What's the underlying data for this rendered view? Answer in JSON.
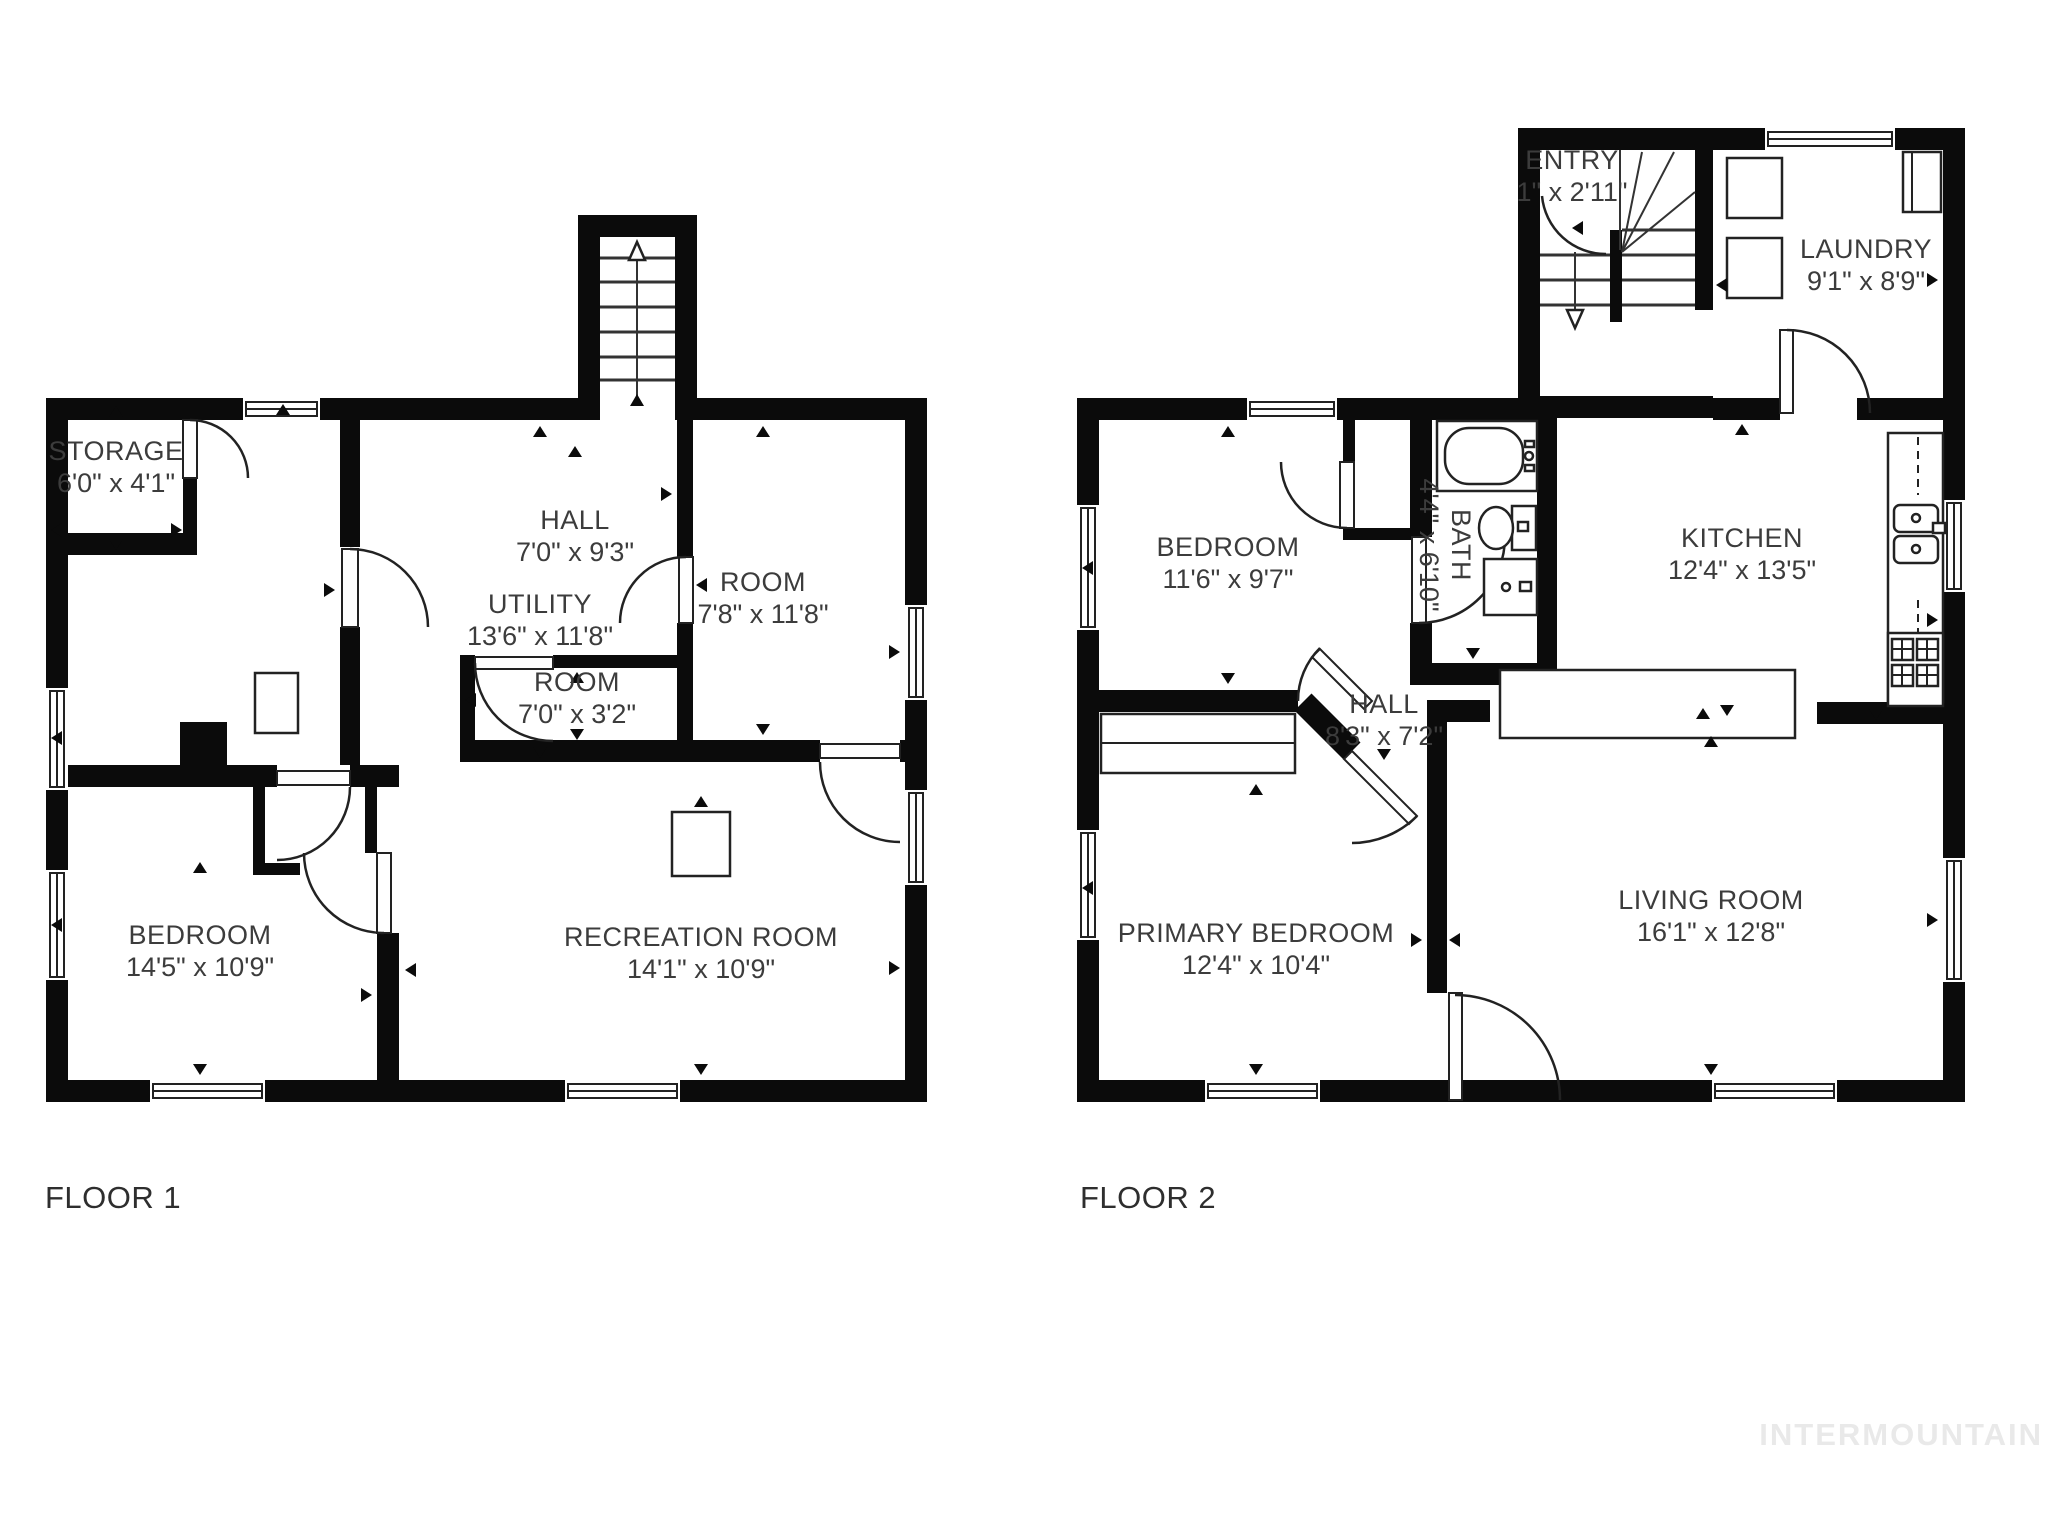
{
  "watermark": {
    "text": "INTERMOUNTAIN"
  },
  "colors": {
    "wall": "#0b0b0b",
    "line": "#222222",
    "label_text": "#3c3c3c",
    "watermark": "#e9e9e9"
  },
  "floor1": {
    "label": "FLOOR 1",
    "rooms": [
      {
        "id": "storage",
        "name": "STORAGE",
        "dims": "6'0\" x 4'1\""
      },
      {
        "id": "utility",
        "name": "UTILITY",
        "dims": "13'6\" x 11'8\""
      },
      {
        "id": "hall",
        "name": "HALL",
        "dims": "7'0\" x 9'3\""
      },
      {
        "id": "room-small",
        "name": "ROOM",
        "dims": "7'0\" x 3'2\""
      },
      {
        "id": "room",
        "name": "ROOM",
        "dims": "7'8\" x 11'8\""
      },
      {
        "id": "bedroom",
        "name": "BEDROOM",
        "dims": "14'5\" x 10'9\""
      },
      {
        "id": "recreation",
        "name": "RECREATION ROOM",
        "dims": "14'1\" x 10'9\""
      }
    ]
  },
  "floor2": {
    "label": "FLOOR 2",
    "rooms": [
      {
        "id": "entry",
        "name": "ENTRY",
        "dims": "1\" x 2'11\""
      },
      {
        "id": "laundry",
        "name": "LAUNDRY",
        "dims": "9'1\" x 8'9\""
      },
      {
        "id": "bedroom",
        "name": "BEDROOM",
        "dims": "11'6\" x 9'7\""
      },
      {
        "id": "bath",
        "name": "BATH",
        "dims": "4'4\" x 6'10\""
      },
      {
        "id": "kitchen",
        "name": "KITCHEN",
        "dims": "12'4\" x 13'5\""
      },
      {
        "id": "hall",
        "name": "HALL",
        "dims": "8'3\" x 7'2\""
      },
      {
        "id": "primary",
        "name": "PRIMARY BEDROOM",
        "dims": "12'4\" x 10'4\""
      },
      {
        "id": "living",
        "name": "LIVING ROOM",
        "dims": "16'1\" x 12'8\""
      }
    ]
  }
}
